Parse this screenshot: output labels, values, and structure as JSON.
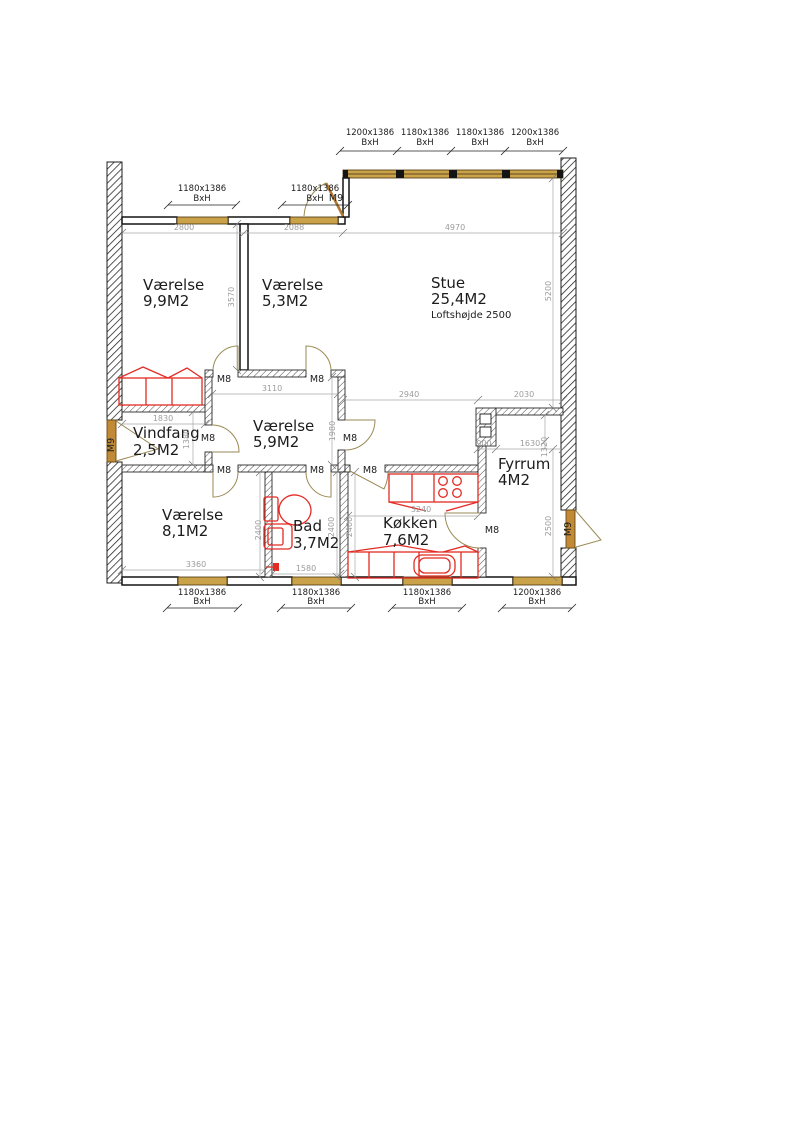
{
  "colors": {
    "wall_black": "#1c1c1c",
    "window_tan": "#c9a24a",
    "door_swing_olive": "#9a8a55",
    "door_leaf_tan": "#c08a36",
    "fixture_red": "#e32b24",
    "dimension_gray": "#9c9c9c"
  },
  "rooms": [
    {
      "name": "Værelse",
      "area": "9,9M2"
    },
    {
      "name": "Værelse",
      "area": "5,3M2"
    },
    {
      "name": "Stue",
      "area": "25,4M2",
      "note": "Loftshøjde 2500"
    },
    {
      "name": "Vindfang",
      "area": "2,5M2"
    },
    {
      "name": "Værelse",
      "area": "5,9M2"
    },
    {
      "name": "Værelse",
      "area": "8,1M2"
    },
    {
      "name": "Bad",
      "area": "3,7M2"
    },
    {
      "name": "Køkken",
      "area": "7,6M2"
    },
    {
      "name": "Fyrrum",
      "area": "4M2"
    }
  ],
  "windows": [
    {
      "size": "1180x1386",
      "bh": "BxH"
    },
    {
      "size": "1180x1386",
      "bh": "BxH"
    },
    {
      "size": "1200x1386",
      "bh": "BxH"
    },
    {
      "size": "1180x1386",
      "bh": "BxH"
    },
    {
      "size": "1180x1386",
      "bh": "BxH"
    },
    {
      "size": "1200x1386",
      "bh": "BxH"
    },
    {
      "size": "1180x1386",
      "bh": "BxH"
    },
    {
      "size": "1180x1386",
      "bh": "BxH"
    },
    {
      "size": "1180x1386",
      "bh": "BxH"
    },
    {
      "size": "1200x1386",
      "bh": "BxH"
    }
  ],
  "doors": [
    {
      "label": "M9"
    },
    {
      "label": "M9"
    },
    {
      "label": "M9"
    },
    {
      "label": "M8"
    },
    {
      "label": "M8"
    },
    {
      "label": "M8"
    },
    {
      "label": "M8"
    },
    {
      "label": "M8"
    },
    {
      "label": "M8"
    },
    {
      "label": "M8"
    },
    {
      "label": "M8"
    }
  ],
  "dims": {
    "room1_w": "2800",
    "room2_w": "2088",
    "stue_w": "4970",
    "rooms_h": "3570",
    "stue_h": "5200",
    "hall_w": "3110",
    "stue_lower_w": "2940",
    "fyrrum_top_w": "2030",
    "vindfang_w": "1830",
    "vindfang_h": "1380",
    "hall_h": "1980",
    "chimney_w": "900",
    "fyrrum_w": "1630",
    "fyrrum_niche_h": "1320",
    "v81_h": "2400",
    "bad_h": "2400",
    "koekken_h": "2400",
    "koekken_w": "3240",
    "v81_w": "3360",
    "bad_w": "1580",
    "fyrrum_h": "2500"
  }
}
